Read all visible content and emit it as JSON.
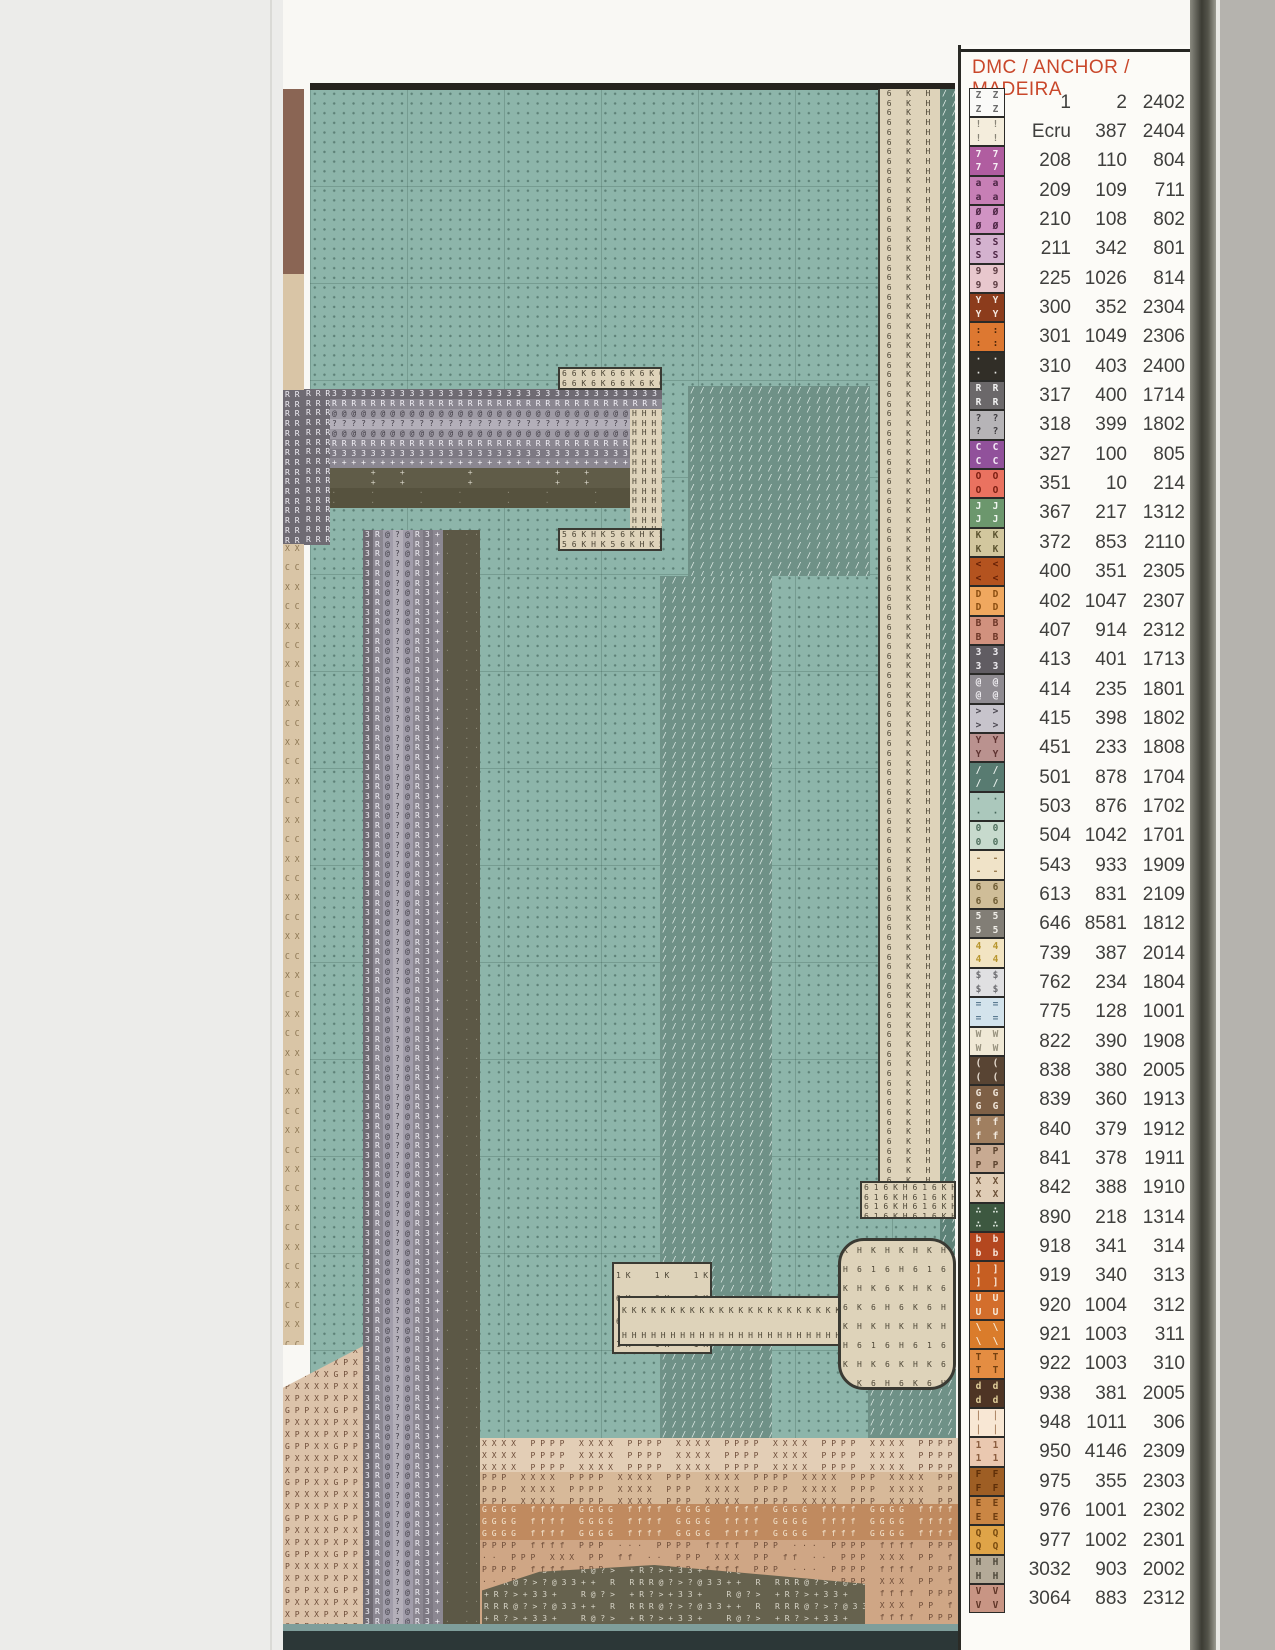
{
  "legend": {
    "title": "DMC / ANCHOR / MADEIRA",
    "title_color": "#c9472a",
    "columns": [
      "DMC",
      "ANCHOR",
      "MADEIRA"
    ],
    "rows": [
      {
        "sym": "Z",
        "bg": "#fafaf8",
        "fg": "#6a6a6a",
        "dmc": "1",
        "anchor": "2",
        "madeira": "2402"
      },
      {
        "sym": "!",
        "bg": "#f4eddc",
        "fg": "#8a8578",
        "dmc": "Ecru",
        "anchor": "387",
        "madeira": "2404"
      },
      {
        "sym": "7",
        "bg": "#b05da0",
        "fg": "#f8f0f6",
        "dmc": "208",
        "anchor": "110",
        "madeira": "804"
      },
      {
        "sym": "a",
        "bg": "#c77fb5",
        "fg": "#4a2342",
        "dmc": "209",
        "anchor": "109",
        "madeira": "711"
      },
      {
        "sym": "Ø",
        "bg": "#d093c3",
        "fg": "#4a2342",
        "dmc": "210",
        "anchor": "108",
        "madeira": "802"
      },
      {
        "sym": "S",
        "bg": "#d4b2cf",
        "fg": "#4a2342",
        "dmc": "211",
        "anchor": "342",
        "madeira": "801"
      },
      {
        "sym": "9",
        "bg": "#e8c7cd",
        "fg": "#5a3a40",
        "dmc": "225",
        "anchor": "1026",
        "madeira": "814"
      },
      {
        "sym": "Y",
        "bg": "#8c3c1c",
        "fg": "#f5e8e0",
        "dmc": "300",
        "anchor": "352",
        "madeira": "2304"
      },
      {
        "sym": ":",
        "bg": "#dd7831",
        "fg": "#4a2408",
        "dmc": "301",
        "anchor": "1049",
        "madeira": "2306"
      },
      {
        "sym": "·",
        "bg": "#312e27",
        "fg": "#e8e8e4",
        "dmc": "310",
        "anchor": "403",
        "madeira": "2400"
      },
      {
        "sym": "R",
        "bg": "#6b686a",
        "fg": "#f2f2f2",
        "dmc": "317",
        "anchor": "400",
        "madeira": "1714"
      },
      {
        "sym": "?",
        "bg": "#b6b4b7",
        "fg": "#3f3d40",
        "dmc": "318",
        "anchor": "399",
        "madeira": "1802"
      },
      {
        "sym": "C",
        "bg": "#91519b",
        "fg": "#f4eaf6",
        "dmc": "327",
        "anchor": "100",
        "madeira": "805"
      },
      {
        "sym": "O",
        "bg": "#ea7260",
        "fg": "#7a1d10",
        "dmc": "351",
        "anchor": "10",
        "madeira": "214"
      },
      {
        "sym": "J",
        "bg": "#6c976d",
        "fg": "#f0f6f0",
        "dmc": "367",
        "anchor": "217",
        "madeira": "1312"
      },
      {
        "sym": "K",
        "bg": "#d2c79e",
        "fg": "#5c5430",
        "dmc": "372",
        "anchor": "853",
        "madeira": "2110"
      },
      {
        "sym": "<",
        "bg": "#b4531f",
        "fg": "#641f05",
        "dmc": "400",
        "anchor": "351",
        "madeira": "2305"
      },
      {
        "sym": "D",
        "bg": "#f0a85f",
        "fg": "#8a4d10",
        "dmc": "402",
        "anchor": "1047",
        "madeira": "2307"
      },
      {
        "sym": "B",
        "bg": "#d1917e",
        "fg": "#6b3526",
        "dmc": "407",
        "anchor": "914",
        "madeira": "2312"
      },
      {
        "sym": "3",
        "bg": "#605c62",
        "fg": "#f0eef2",
        "dmc": "413",
        "anchor": "401",
        "madeira": "1713"
      },
      {
        "sym": "@",
        "bg": "#8f8b91",
        "fg": "#efedf1",
        "dmc": "414",
        "anchor": "235",
        "madeira": "1801"
      },
      {
        "sym": ">",
        "bg": "#c7c4cc",
        "fg": "#4c4952",
        "dmc": "415",
        "anchor": "398",
        "madeira": "1802"
      },
      {
        "sym": "Y",
        "bg": "#ba928f",
        "fg": "#5e3230",
        "dmc": "451",
        "anchor": "233",
        "madeira": "1808"
      },
      {
        "sym": "/",
        "bg": "#587b71",
        "fg": "#e8f0ec",
        "dmc": "501",
        "anchor": "878",
        "madeira": "1704"
      },
      {
        "sym": "·",
        "bg": "#abc8bc",
        "fg": "#44665a",
        "dmc": "503",
        "anchor": "876",
        "madeira": "1702"
      },
      {
        "sym": "0",
        "bg": "#c7dacd",
        "fg": "#50705e",
        "dmc": "504",
        "anchor": "1042",
        "madeira": "1701"
      },
      {
        "sym": "-",
        "bg": "#f0e3c8",
        "fg": "#9a7c50",
        "dmc": "543",
        "anchor": "933",
        "madeira": "1909"
      },
      {
        "sym": "6",
        "bg": "#cfbd98",
        "fg": "#6e5c34",
        "dmc": "613",
        "anchor": "831",
        "madeira": "2109"
      },
      {
        "sym": "5",
        "bg": "#827e76",
        "fg": "#f0eee8",
        "dmc": "646",
        "anchor": "8581",
        "madeira": "1812"
      },
      {
        "sym": "4",
        "bg": "#f2e4c2",
        "fg": "#b8962e",
        "dmc": "739",
        "anchor": "387",
        "madeira": "2014"
      },
      {
        "sym": "$",
        "bg": "#e0e0e2",
        "fg": "#6e6e72",
        "dmc": "762",
        "anchor": "234",
        "madeira": "1804"
      },
      {
        "sym": "=",
        "bg": "#d3e3ec",
        "fg": "#5a7a90",
        "dmc": "775",
        "anchor": "128",
        "madeira": "1001"
      },
      {
        "sym": "W",
        "bg": "#f0e9d6",
        "fg": "#9a9480",
        "dmc": "822",
        "anchor": "390",
        "madeira": "1908"
      },
      {
        "sym": "(",
        "bg": "#584433",
        "fg": "#e8ddd0",
        "dmc": "838",
        "anchor": "380",
        "madeira": "2005"
      },
      {
        "sym": "G",
        "bg": "#7e6046",
        "fg": "#f0e6da",
        "dmc": "839",
        "anchor": "360",
        "madeira": "1913"
      },
      {
        "sym": "f",
        "bg": "#a07f60",
        "fg": "#f2e8dc",
        "dmc": "840",
        "anchor": "379",
        "madeira": "1912"
      },
      {
        "sym": "P",
        "bg": "#c8aa92",
        "fg": "#5e4530",
        "dmc": "841",
        "anchor": "378",
        "madeira": "1911"
      },
      {
        "sym": "X",
        "bg": "#e0cdb6",
        "fg": "#6b5138",
        "dmc": "842",
        "anchor": "388",
        "madeira": "1910"
      },
      {
        "sym": "∴",
        "bg": "#3d5840",
        "fg": "#e6efe6",
        "dmc": "890",
        "anchor": "218",
        "madeira": "1314"
      },
      {
        "sym": "b",
        "bg": "#b4471f",
        "fg": "#f6e2d6",
        "dmc": "918",
        "anchor": "341",
        "madeira": "314"
      },
      {
        "sym": "]",
        "bg": "#c65e22",
        "fg": "#f8e8da",
        "dmc": "919",
        "anchor": "340",
        "madeira": "313"
      },
      {
        "sym": "U",
        "bg": "#d36e2c",
        "fg": "#f8ead8",
        "dmc": "920",
        "anchor": "1004",
        "madeira": "312"
      },
      {
        "sym": "\\",
        "bg": "#da7c2b",
        "fg": "#f8ecd8",
        "dmc": "921",
        "anchor": "1003",
        "madeira": "311"
      },
      {
        "sym": "T",
        "bg": "#e48d42",
        "fg": "#744010",
        "dmc": "922",
        "anchor": "1003",
        "madeira": "310"
      },
      {
        "sym": "d",
        "bg": "#4e3424",
        "fg": "#e0ce9a",
        "dmc": "938",
        "anchor": "381",
        "madeira": "2005"
      },
      {
        "sym": "|",
        "bg": "#f8e7d4",
        "fg": "#b08a6a",
        "dmc": "948",
        "anchor": "1011",
        "madeira": "306"
      },
      {
        "sym": "1",
        "bg": "#eac8b0",
        "fg": "#8a5c3e",
        "dmc": "950",
        "anchor": "4146",
        "madeira": "2309"
      },
      {
        "sym": "F",
        "bg": "#9e5e24",
        "fg": "#5e2e08",
        "dmc": "975",
        "anchor": "355",
        "madeira": "2303"
      },
      {
        "sym": "E",
        "bg": "#ca8644",
        "fg": "#6e3c10",
        "dmc": "976",
        "anchor": "1001",
        "madeira": "2302"
      },
      {
        "sym": "Q",
        "bg": "#dfa448",
        "fg": "#7a4c10",
        "dmc": "977",
        "anchor": "1002",
        "madeira": "2301"
      },
      {
        "sym": "H",
        "bg": "#b4aa98",
        "fg": "#4e483a",
        "dmc": "3032",
        "anchor": "903",
        "madeira": "2002"
      },
      {
        "sym": "V",
        "bg": "#c89584",
        "fg": "#5e3426",
        "dmc": "3064",
        "anchor": "883",
        "madeira": "2312"
      }
    ]
  },
  "chart": {
    "fabric_color": "#8db5aa",
    "cell_size": 9.7,
    "pole_symbol_sequence": "3R@?@R3+",
    "border_symbol_sequence": "6 K H",
    "regions": [
      {
        "name": "fabric-grid",
        "x": 310,
        "y": 89,
        "w": 645,
        "h": 1541,
        "cls": "teal"
      },
      {
        "name": "chart-top-border",
        "x": 310,
        "y": 83,
        "w": 645,
        "h": 7,
        "bg": "#26231e"
      },
      {
        "name": "left-edge-strip-brown",
        "x": 283,
        "y": 89,
        "w": 21,
        "h": 185,
        "bg": "#8a6554"
      },
      {
        "name": "left-edge-strip-tan",
        "x": 283,
        "y": 274,
        "w": 21,
        "h": 116,
        "bg": "#d9c5a6"
      },
      {
        "name": "left-edge-strip-gray",
        "x": 283,
        "y": 390,
        "w": 21,
        "h": 154,
        "bg": "#6f6b73",
        "fg": "#f2f0f6",
        "rows": [
          "R"
        ]
      },
      {
        "name": "left-edge-strip-lower",
        "x": 283,
        "y": 544,
        "w": 21,
        "h": 801,
        "bg": "#d9c5a6",
        "fg": "#8a7450",
        "rows": [
          "X",
          "",
          "C",
          ""
        ]
      },
      {
        "name": "foliage-slash-patch",
        "x": 688,
        "y": 386,
        "w": 182,
        "h": 190,
        "bg": "#6f9187",
        "fg": "#dfeae6",
        "rows": [
          "/"
        ]
      },
      {
        "name": "trunk-slash-band",
        "x": 660,
        "y": 576,
        "w": 112,
        "h": 894,
        "bg": "#6f9187",
        "fg": "#dfeae6",
        "rows": [
          "/"
        ]
      },
      {
        "name": "slash-bottom-right",
        "x": 868,
        "y": 1369,
        "w": 88,
        "h": 196,
        "bg": "#6f9187",
        "fg": "#dfeae6",
        "rows": [
          "/"
        ]
      },
      {
        "name": "crossarm-row-3-top",
        "x": 330,
        "y": 389,
        "w": 332,
        "h": 10,
        "bg": "#6f6b73",
        "fg": "#f2f0f6",
        "rows": [
          "3"
        ]
      },
      {
        "name": "crossarm-row-r-top",
        "x": 330,
        "y": 399,
        "w": 332,
        "h": 10,
        "bg": "#8b8791",
        "fg": "#f2f0f6",
        "rows": [
          "R"
        ]
      },
      {
        "name": "crossarm-row-at-top",
        "x": 330,
        "y": 409,
        "w": 332,
        "h": 10,
        "bg": "#9e9aa4",
        "fg": "#413d46",
        "rows": [
          "@"
        ]
      },
      {
        "name": "crossarm-row-q",
        "x": 330,
        "y": 419,
        "w": 332,
        "h": 10,
        "bg": "#b3afb9",
        "fg": "#413d46",
        "rows": [
          "?"
        ]
      },
      {
        "name": "crossarm-row-at-bottom",
        "x": 330,
        "y": 429,
        "w": 332,
        "h": 10,
        "bg": "#9e9aa4",
        "fg": "#413d46",
        "rows": [
          "@"
        ]
      },
      {
        "name": "crossarm-row-r-bottom",
        "x": 330,
        "y": 439,
        "w": 332,
        "h": 10,
        "bg": "#8b8791",
        "fg": "#f2f0f6",
        "rows": [
          "R"
        ]
      },
      {
        "name": "crossarm-row-3-bottom",
        "x": 330,
        "y": 449,
        "w": 332,
        "h": 10,
        "bg": "#7d7983",
        "fg": "#f2f0f6",
        "rows": [
          "3"
        ]
      },
      {
        "name": "crossarm-row-plus",
        "x": 330,
        "y": 458,
        "w": 332,
        "h": 10,
        "bg": "#8b8791",
        "fg": "#f6f4f8",
        "rows": [
          "+"
        ]
      },
      {
        "name": "crossarm-shadow-upper",
        "x": 330,
        "y": 468,
        "w": 332,
        "h": 20,
        "bg": "#605c48",
        "fg": "#d8d5c8",
        "rows": [
          "    +  +      +    "
        ]
      },
      {
        "name": "crossarm-shadow-lower",
        "x": 310,
        "y": 488,
        "w": 352,
        "h": 20,
        "bg": "#56523e",
        "fg": "#8d8a78",
        "rows": [
          "  ·   ·  "
        ]
      },
      {
        "name": "crossarm-left-rr-block",
        "x": 304,
        "y": 389,
        "w": 26,
        "h": 156,
        "bg": "#6f6b73",
        "fg": "#f2f0f6",
        "rows": [
          "RR"
        ]
      },
      {
        "name": "crossarm-end-steps-top",
        "x": 558,
        "y": 367,
        "w": 104,
        "h": 23,
        "bg": "#ded3ba",
        "fg": "#4d4636",
        "rows": [
          "66K6K"
        ],
        "border": "2px solid #3a3a33"
      },
      {
        "name": "crossarm-end-kh-strip",
        "x": 630,
        "y": 409,
        "w": 32,
        "h": 120,
        "bg": "#ded3ba",
        "fg": "#4d4636",
        "rows": [
          "HH"
        ]
      },
      {
        "name": "crossarm-end-steps-bottom",
        "x": 558,
        "y": 528,
        "w": 104,
        "h": 23,
        "bg": "#ded3ba",
        "fg": "#4d4636",
        "rows": [
          "56KHK"
        ],
        "border": "2px solid #3a3a33"
      },
      {
        "name": "right-border-6kh-column",
        "x": 878,
        "y": 89,
        "w": 62,
        "h": 1126,
        "bg": "#ded3ba",
        "fg": "#4d4636",
        "rows": [
          "6 K H"
        ],
        "tile": false,
        "center": true,
        "border": "0 solid",
        "borderLeft": "2px solid #3a3a33"
      },
      {
        "name": "right-border-slash-column",
        "x": 940,
        "y": 89,
        "w": 15,
        "h": 1280,
        "bg": "#5d8177",
        "fg": "#e8f0ec",
        "rows": [
          "/"
        ]
      },
      {
        "name": "insulator-block-616kh",
        "x": 860,
        "y": 1181,
        "w": 96,
        "h": 38,
        "bg": "#ded3ba",
        "fg": "#4d4636",
        "rows": [
          "616KH"
        ],
        "border": "2px solid #3a3a33"
      },
      {
        "name": "small-bracket",
        "x": 612,
        "y": 1262,
        "w": 100,
        "h": 92,
        "bg": "#ded3ba",
        "fg": "#4d4636",
        "rows": [
          "1K  ",
          "6K  ",
          "6KKK"
        ],
        "ch": 23,
        "border": "2px solid #3a3a33"
      },
      {
        "name": "crossarm-kh-arm",
        "x": 618,
        "y": 1296,
        "w": 228,
        "h": 50,
        "bg": "#ded3ba",
        "fg": "#4d4636",
        "rows": [
          "KKKKKKKKKKKKKKKKKKKKKKKK",
          "HHHHHHHHHHHHHHHHHHHHHHHH"
        ],
        "ch": 25,
        "border": "2px solid #3a3a33"
      },
      {
        "name": "octagon-joint",
        "x": 838,
        "y": 1238,
        "w": 118,
        "h": 152,
        "bg": "#ded3ba",
        "fg": "#4d4636",
        "rows": [
          "KHKH",
          "H616",
          "KHK6",
          "6K6H"
        ],
        "ch": 19,
        "cw": 14,
        "border": "3px solid #3a3a33",
        "radius": 26
      },
      {
        "name": "terrain-left",
        "x": 283,
        "y": 1345,
        "w": 82,
        "h": 305,
        "bg": "#dcc3aa",
        "fg": "#6d4c38",
        "rows": [
          "PXXXX",
          "XPXXP",
          "GPPXX"
        ],
        "ch": 12,
        "clip": "polygon(0 14%,100% 0,100% 100%,0 100%)"
      },
      {
        "name": "terrain-right-band-x",
        "x": 480,
        "y": 1438,
        "w": 478,
        "h": 34,
        "bg": "#e3ceb6",
        "fg": "#6d4c38",
        "rows": [
          "XXXX PPPP XXXX PPPP "
        ],
        "ch": 12
      },
      {
        "name": "terrain-right-band-p",
        "x": 480,
        "y": 1472,
        "w": 478,
        "h": 32,
        "bg": "#d7b999",
        "fg": "#6d4c38",
        "rows": [
          "PPP XXXX PPPP XXXX "
        ],
        "ch": 12
      },
      {
        "name": "terrain-right-band-g",
        "x": 480,
        "y": 1504,
        "w": 478,
        "h": 36,
        "bg": "#c08a5f",
        "fg": "#f4e6d0",
        "rows": [
          "GGGG ffff GGGG ffff "
        ],
        "ch": 12
      },
      {
        "name": "terrain-right-band-low",
        "x": 480,
        "y": 1540,
        "w": 478,
        "h": 110,
        "bg": "#cfa685",
        "fg": "#6d4c38",
        "rows": [
          "PPPP ffff PPP ··· ",
          "·· PPP XXX PP ff "
        ],
        "ch": 12
      },
      {
        "name": "rock-pile",
        "x": 482,
        "y": 1565,
        "w": 383,
        "h": 85,
        "bg": "#66624e",
        "fg": "#d8d5c8",
        "rows": [
          "+R?>+33+  R@?> ",
          "RRR@?>?@33++ R "
        ],
        "ch": 12,
        "clip": "polygon(0 30%,15% 8%,45% 0,100% 22%,100% 100%,0 100%)"
      },
      {
        "name": "pole-col-3-left",
        "x": 363,
        "y": 530,
        "w": 10,
        "h": 1120,
        "bg": "#6f6b73",
        "fg": "#f2f0f6",
        "rows": [
          "3"
        ]
      },
      {
        "name": "pole-col-r-left",
        "x": 373,
        "y": 530,
        "w": 10,
        "h": 1120,
        "bg": "#8b8791",
        "fg": "#f2f0f6",
        "rows": [
          "R"
        ]
      },
      {
        "name": "pole-col-at-left",
        "x": 383,
        "y": 530,
        "w": 10,
        "h": 1120,
        "bg": "#a19daa",
        "fg": "#43404a",
        "rows": [
          "@"
        ]
      },
      {
        "name": "pole-col-q",
        "x": 393,
        "y": 530,
        "w": 10,
        "h": 1120,
        "bg": "#b3afb9",
        "fg": "#43404a",
        "rows": [
          "?"
        ]
      },
      {
        "name": "pole-col-at-right",
        "x": 403,
        "y": 530,
        "w": 10,
        "h": 1120,
        "bg": "#a19daa",
        "fg": "#43404a",
        "rows": [
          "@"
        ]
      },
      {
        "name": "pole-col-r-right",
        "x": 413,
        "y": 530,
        "w": 10,
        "h": 1120,
        "bg": "#8b8791",
        "fg": "#f2f0f6",
        "rows": [
          "R"
        ]
      },
      {
        "name": "pole-col-3-right",
        "x": 423,
        "y": 530,
        "w": 10,
        "h": 1120,
        "bg": "#7d7983",
        "fg": "#f2f0f6",
        "rows": [
          "3"
        ]
      },
      {
        "name": "pole-col-plus",
        "x": 433,
        "y": 530,
        "w": 10,
        "h": 1120,
        "bg": "#8b8791",
        "fg": "#f6f4f8",
        "rows": [
          "+"
        ]
      },
      {
        "name": "pole-shadow-column",
        "x": 443,
        "y": 530,
        "w": 37,
        "h": 1120,
        "bg": "#5c5846",
        "fg": "#8d8a78",
        "rows": [
          "· ·",
          "  ·"
        ]
      },
      {
        "name": "scan-bottom-highlight",
        "x": 283,
        "y": 1624,
        "w": 907,
        "h": 7,
        "bg": "#7f9e9b"
      },
      {
        "name": "scan-bottom-band",
        "x": 283,
        "y": 1631,
        "w": 907,
        "h": 19,
        "bg": "#2c3737"
      }
    ]
  }
}
